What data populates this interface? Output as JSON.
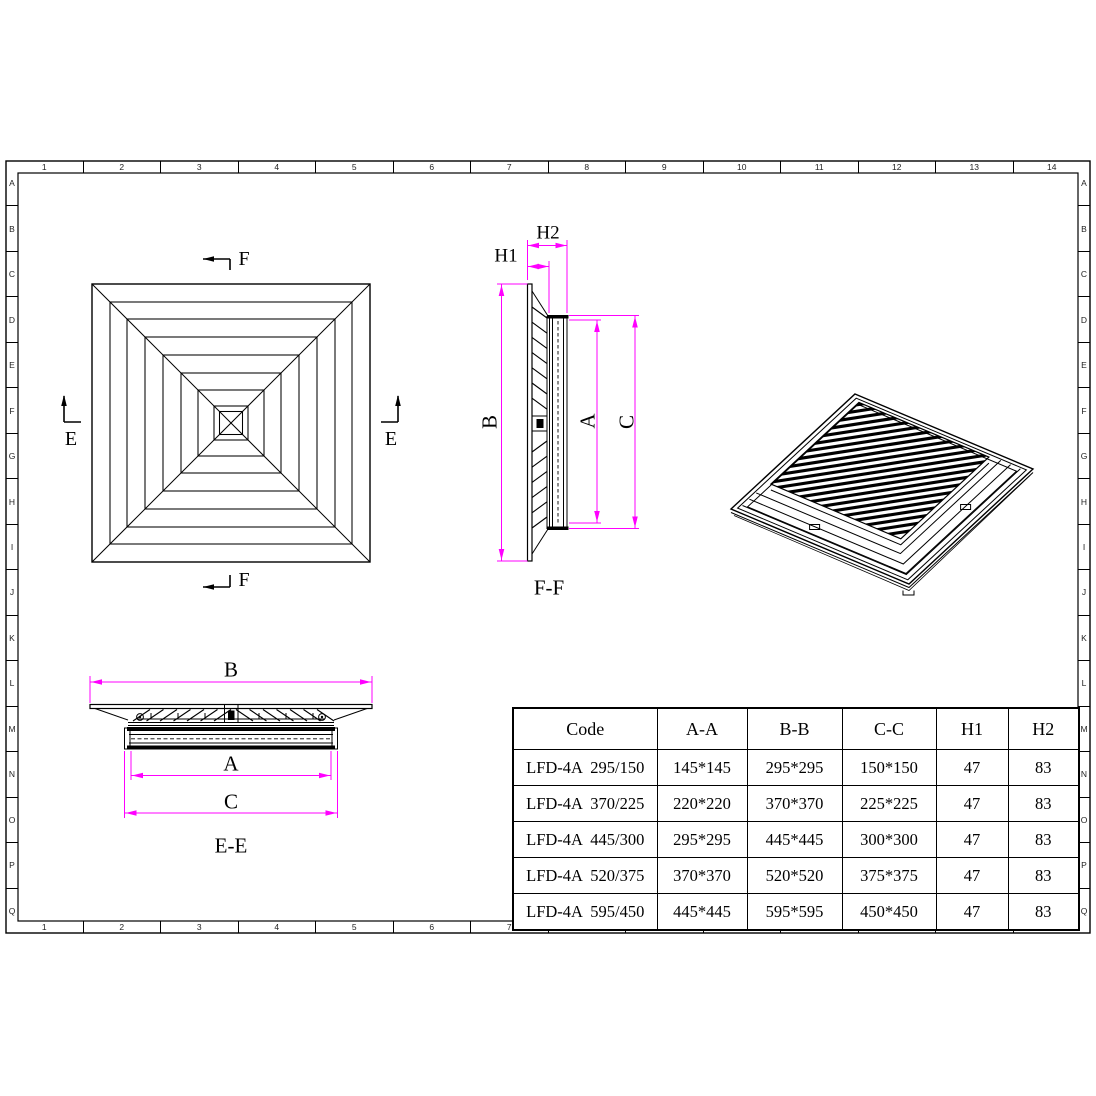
{
  "colors": {
    "background": "#ffffff",
    "line": "#000000",
    "dimension": "#ff00ff"
  },
  "grid_refs": {
    "columns": [
      "1",
      "2",
      "3",
      "4",
      "5",
      "6",
      "7",
      "8",
      "9",
      "10",
      "11",
      "12",
      "13",
      "14"
    ],
    "rows": [
      "A",
      "B",
      "C",
      "D",
      "E",
      "F",
      "G",
      "H",
      "I",
      "J",
      "K",
      "L",
      "M",
      "N",
      "O",
      "P",
      "Q"
    ]
  },
  "plan_view": {
    "marker_f_top": "F",
    "marker_f_bottom": "F",
    "marker_e_left": "E",
    "marker_e_right": "E"
  },
  "ff_section": {
    "label": "F-F",
    "dim_h1": "H1",
    "dim_h2": "H2",
    "dim_b": "B",
    "dim_a": "A",
    "dim_c": "C"
  },
  "ee_section": {
    "label": "E-E",
    "dim_b": "B",
    "dim_a": "A",
    "dim_c": "C"
  },
  "spec_table": {
    "headers": [
      "Code",
      "A-A",
      "B-B",
      "C-C",
      "H1",
      "H2"
    ],
    "col_widths": [
      144,
      90,
      95,
      94,
      72,
      71
    ],
    "rows": [
      [
        "LFD-4A  295/150",
        "145*145",
        "295*295",
        "150*150",
        "47",
        "83"
      ],
      [
        "LFD-4A  370/225",
        "220*220",
        "370*370",
        "225*225",
        "47",
        "83"
      ],
      [
        "LFD-4A  445/300",
        "295*295",
        "445*445",
        "300*300",
        "47",
        "83"
      ],
      [
        "LFD-4A  520/375",
        "370*370",
        "520*520",
        "375*375",
        "47",
        "83"
      ],
      [
        "LFD-4A  595/450",
        "445*445",
        "595*595",
        "450*450",
        "47",
        "83"
      ]
    ]
  }
}
